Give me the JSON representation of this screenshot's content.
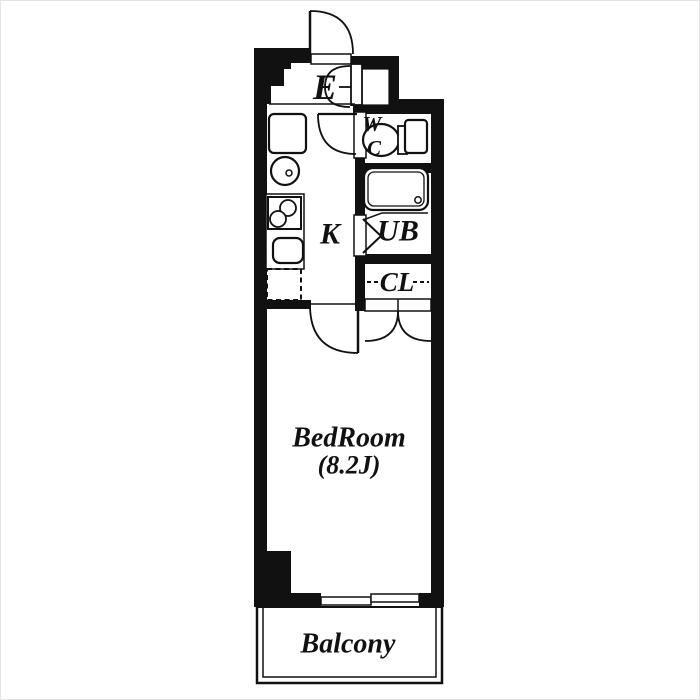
{
  "palette": {
    "wall_color": "#111111",
    "line_color": "#111111",
    "floor_color": "#ffffff",
    "page_border": "#e4e4e4"
  },
  "floorplan": {
    "rooms": {
      "entrance": {
        "label": "E"
      },
      "toilet": {
        "letter_top": "W",
        "letter_bottom": "C"
      },
      "kitchen": {
        "label": "K"
      },
      "bath": {
        "label": "UB"
      },
      "closet": {
        "label": "CL"
      },
      "bedroom": {
        "label": "BedRoom",
        "size": "(8.2J)"
      },
      "balcony": {
        "label": "Balcony"
      }
    }
  }
}
